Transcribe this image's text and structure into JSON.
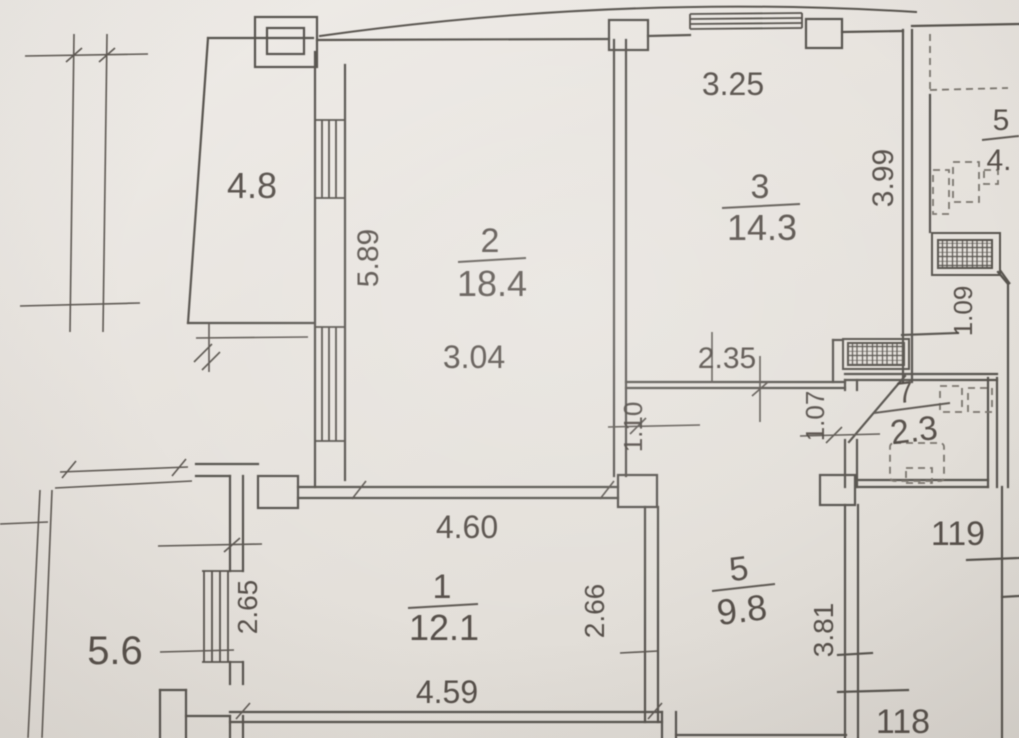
{
  "plan": {
    "apartment_numbers": {
      "left": "118",
      "right": "119"
    },
    "rooms": [
      {
        "number": "1",
        "area": "12.1"
      },
      {
        "number": "2",
        "area": "18.4"
      },
      {
        "number": "3",
        "area": "14.3"
      },
      {
        "number": "5",
        "area": "9.8"
      },
      {
        "number": "7",
        "area": "2.3"
      },
      {
        "number": "5",
        "area": "4."
      }
    ],
    "balconies": [
      {
        "area": "4.8"
      },
      {
        "area": "5.6"
      }
    ],
    "dimensions": {
      "d589": "5.89",
      "d304": "3.04",
      "d325": "3.25",
      "d399": "3.99",
      "d235": "2.35",
      "d110": "1.10",
      "d107": "1.07",
      "d109": "1.09",
      "d460": "4.60",
      "d459": "4.59",
      "d265": "2.65",
      "d266": "2.66",
      "d381": "3.81"
    }
  }
}
